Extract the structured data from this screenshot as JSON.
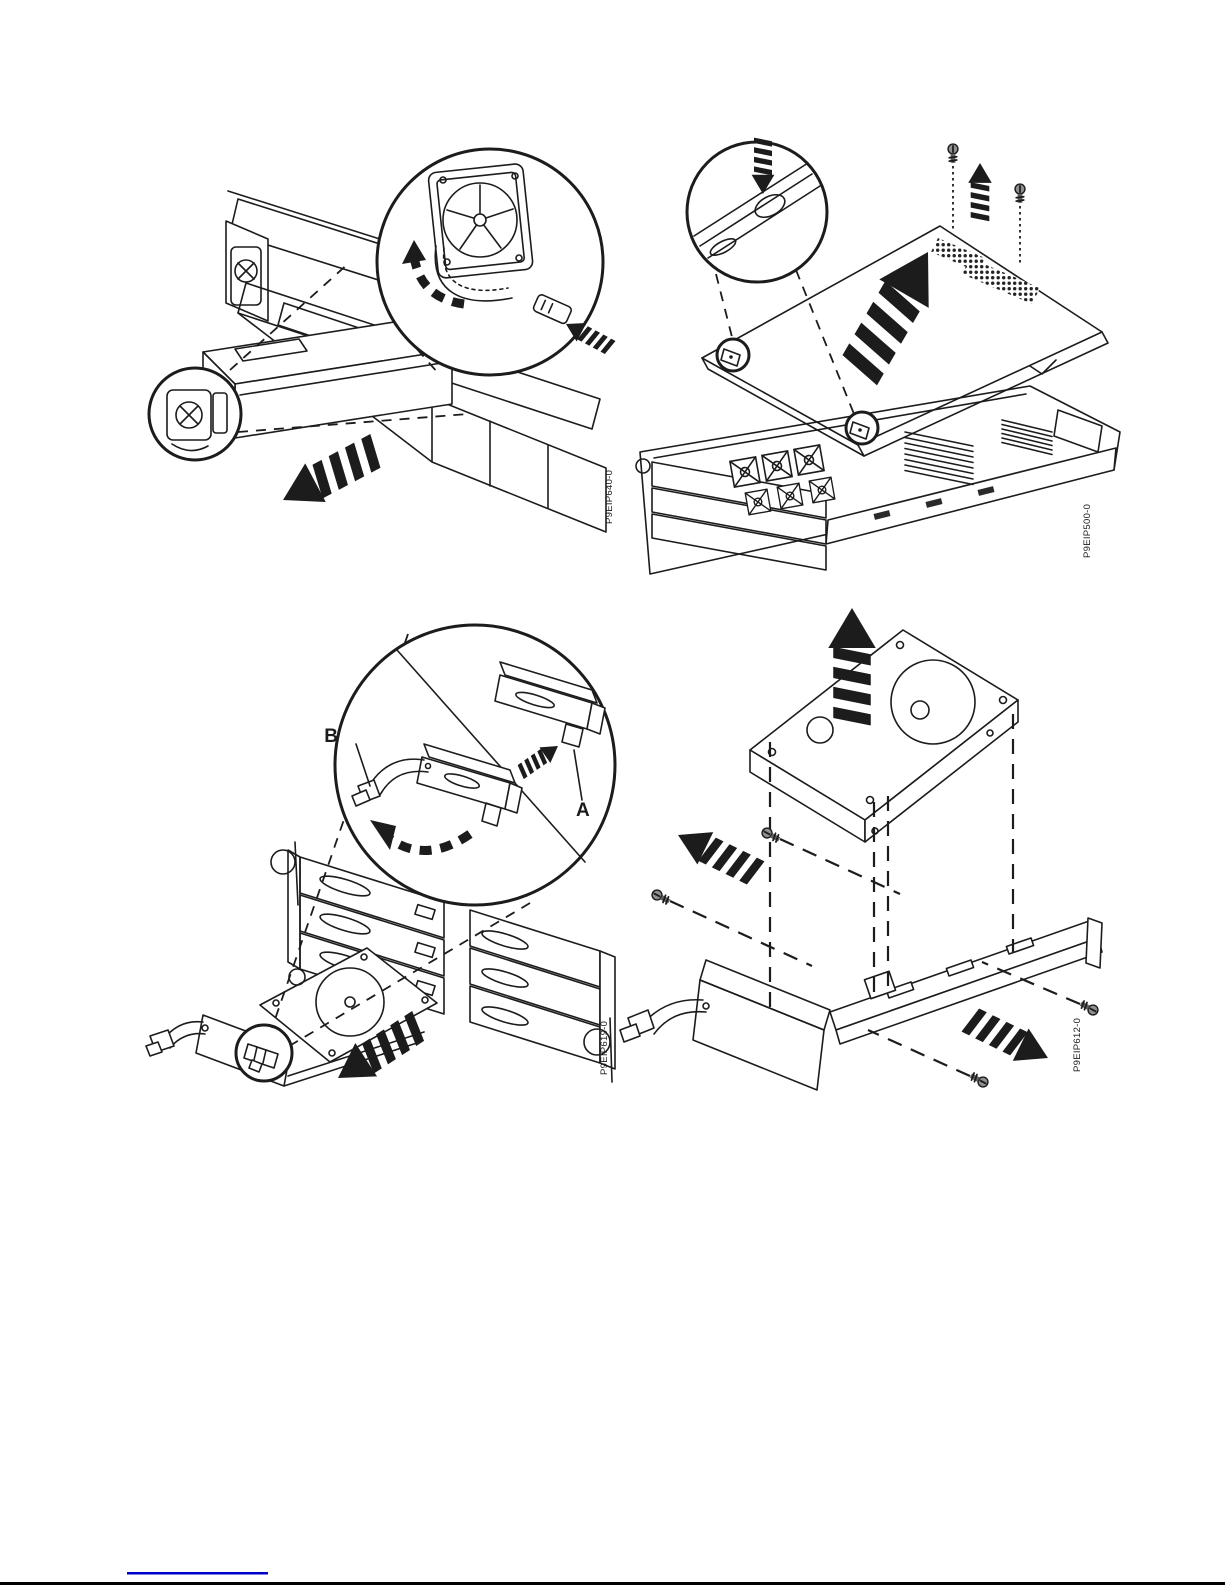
{
  "figures": {
    "psu_removal": {
      "figure_id": "P9EIP640-0"
    },
    "cover_removal": {
      "figure_id": "P9EIP500-0"
    },
    "drive_removal": {
      "figure_id": "P9EIP619-0",
      "callout_a": "A",
      "callout_b": "B"
    },
    "drive_carrier": {
      "figure_id": "P9EIP612-0"
    }
  },
  "colors": {
    "line": "#1c1c1c",
    "cover_gray": "#d9d9d9",
    "latch_blue": "#4a7ed2",
    "button_gray": "#c9c9c9",
    "link_blue": "#0000cc",
    "page_border": "#000000"
  }
}
